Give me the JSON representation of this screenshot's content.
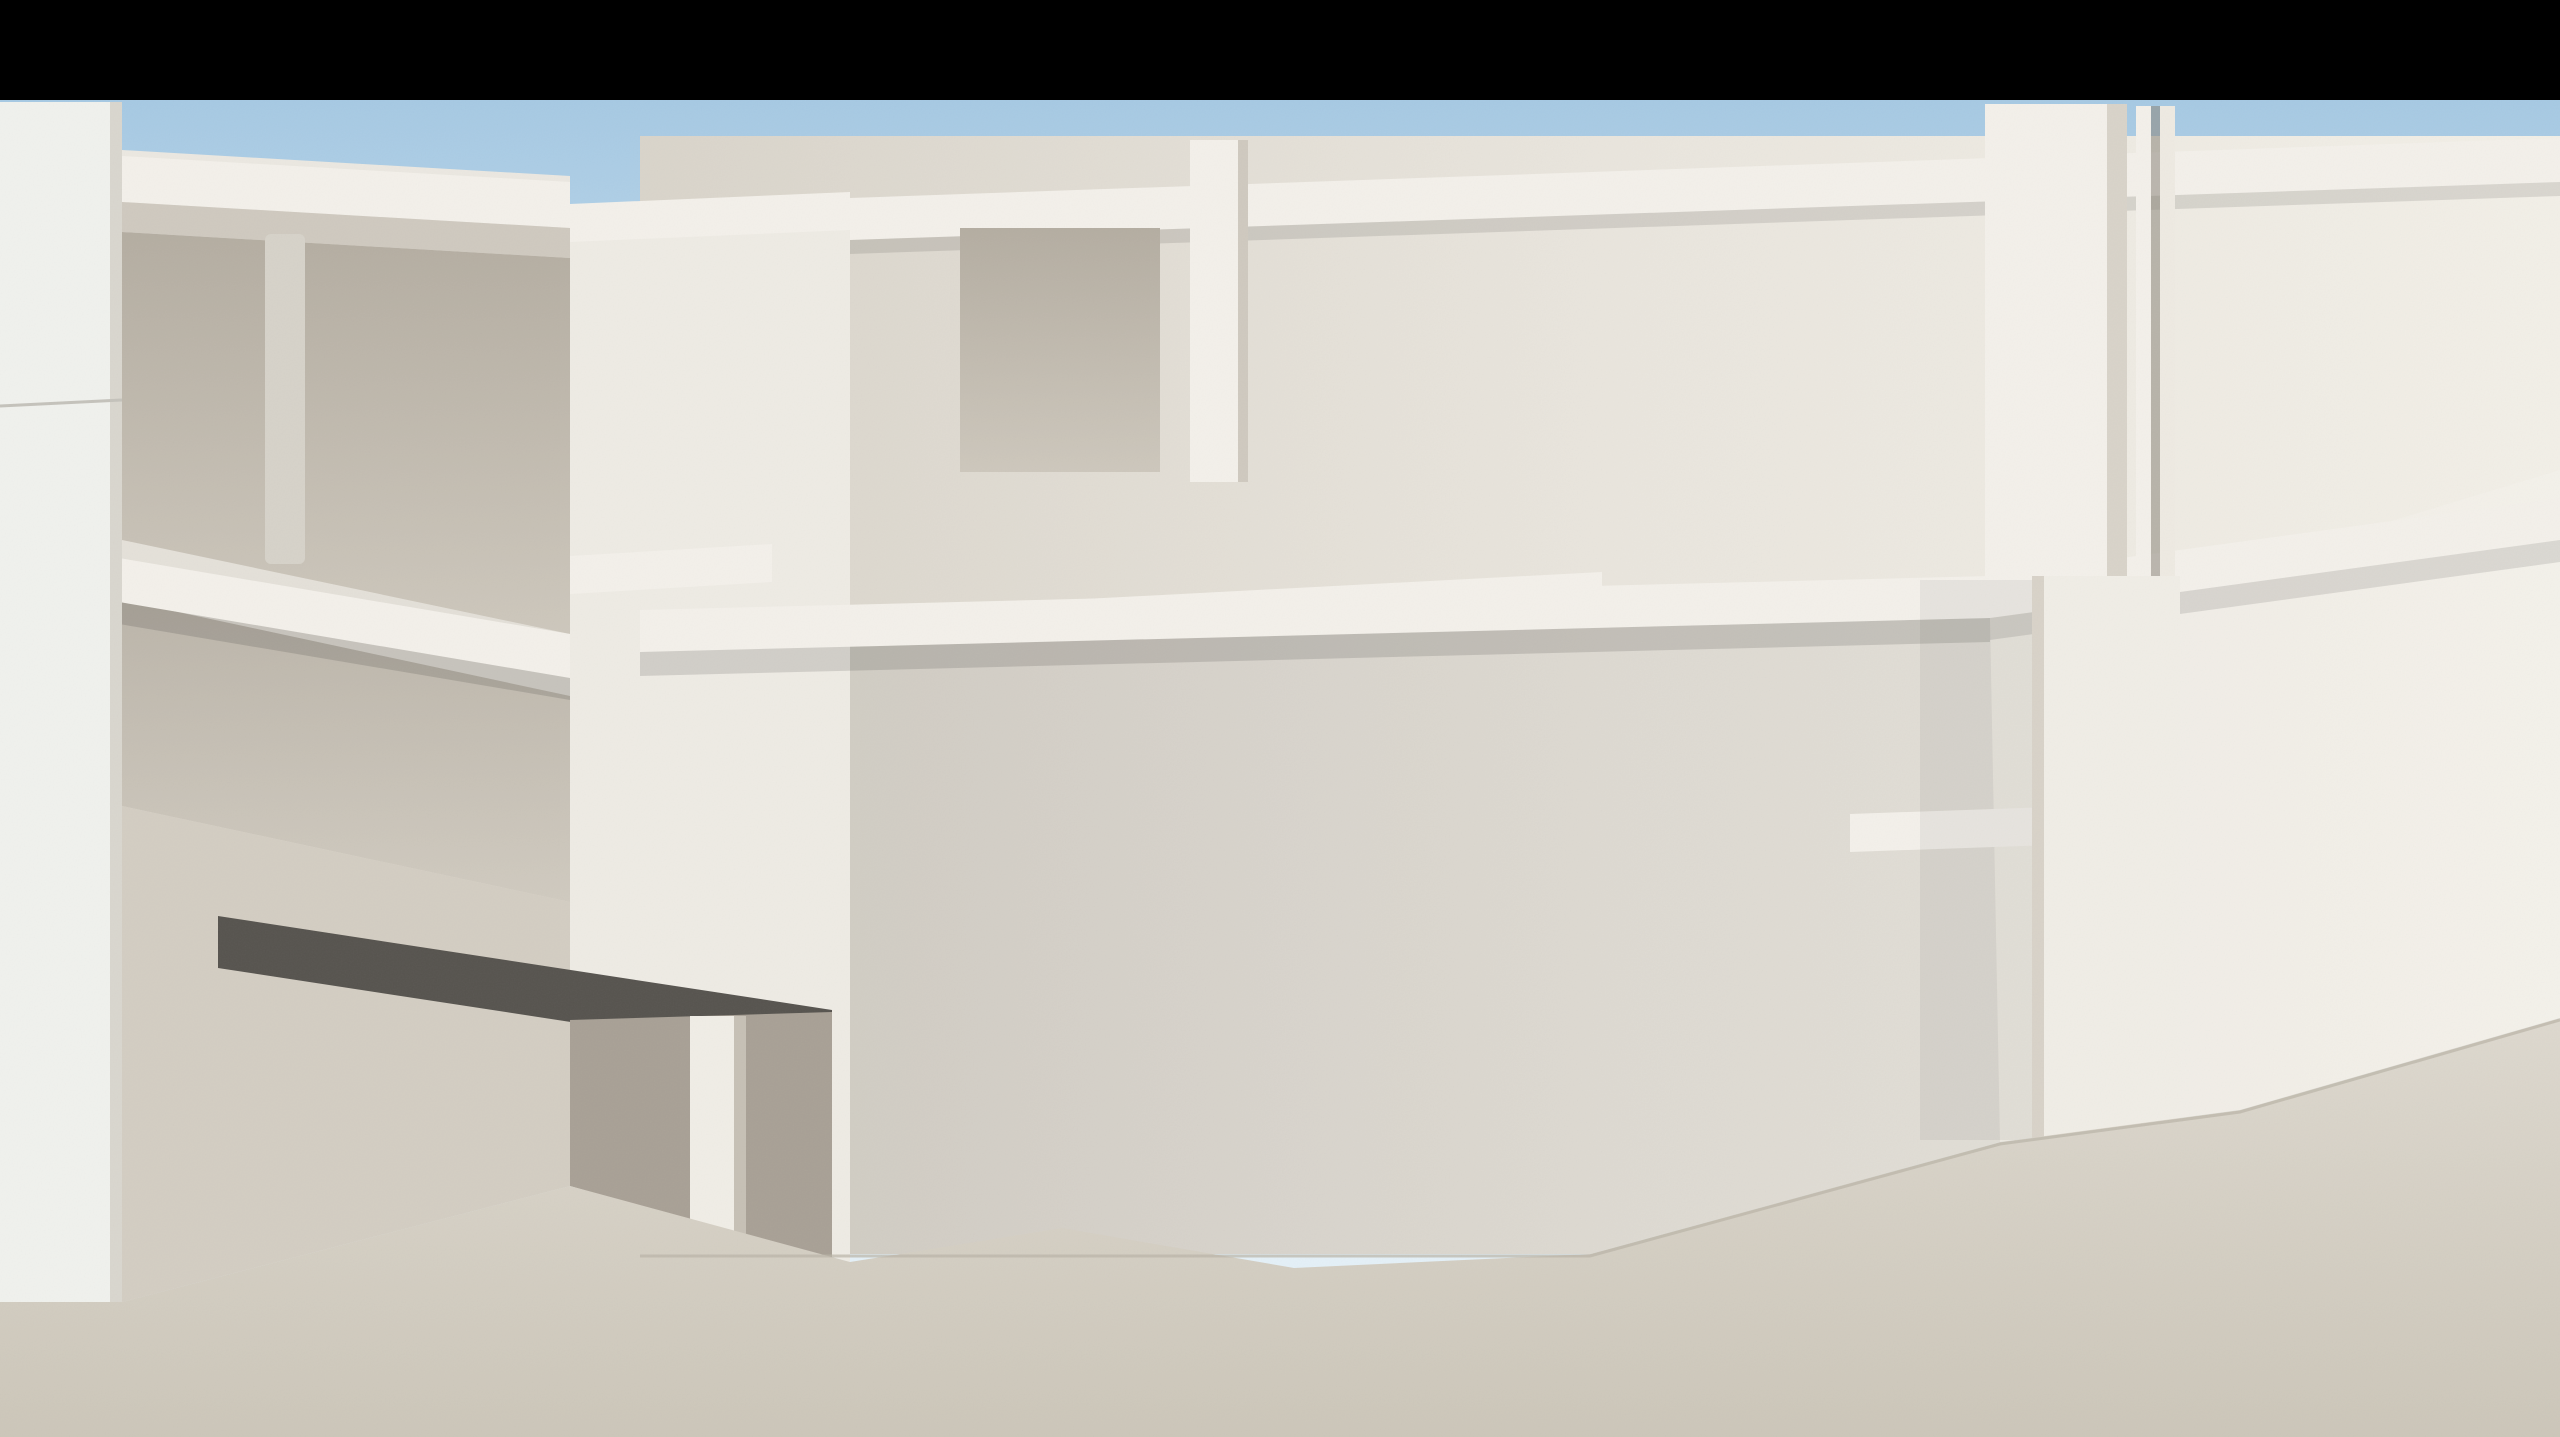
{
  "scene": {
    "kind": "3d-architectural-exterior-render",
    "subject": "modern white resort apartment complex courtyard with swimming pool, wooden deck, sun loungers, tropical plants and fountains",
    "letterbox_top_px": 100,
    "palette": {
      "letterbox": "#000000",
      "skyTop": "#a6c9e3",
      "skyMid": "#c9e0f0",
      "skyLow": "#e4f0f7",
      "cloud": "#f7fbfd",
      "wallBright": "#f3f0ea",
      "wall": "#e9e5de",
      "wallShade": "#d8d3c9",
      "wallDark": "#c6c0b5",
      "recess": "#c3bcb1",
      "interior": "#a8a095",
      "soffitDark": "#56534e",
      "frame": "#1e1d1b",
      "frameBrown": "#6e5c49",
      "curtain": "#d2c8b8",
      "curtainLit": "#ece4d6",
      "slate": "#3f413e",
      "slateDark": "#2f312e",
      "slateLight": "#4b4d4a",
      "stone": "#9c9183",
      "stoneDark": "#8a8073",
      "stoneLight": "#a89d8d",
      "deck": "#cda272",
      "deckDark": "#9f7749",
      "plankGap": "#463a2b",
      "island": "#d6ab79",
      "pave": "#d9d4c9",
      "paveDark": "#c3bdb0",
      "waterDeep": "#72c2bc",
      "water": "#a5d8d2",
      "waterPale": "#d9ece7",
      "poolLip": "#f1ece1",
      "grass": "#2a4522",
      "leafDark": "#2e5129",
      "leaf": "#4c7b42",
      "leafLight": "#79a75d",
      "flowerRed": "#bf2433",
      "flowerPink": "#c77fae",
      "woodFrame": "#c08a4a",
      "woodLeg": "#a97034",
      "cushion": "#f3efe6",
      "cushionShade": "#dcd5c6",
      "towel": "#f5f2ea",
      "potGrey": "#8f8c85",
      "potTan": "#c9b79e",
      "bollard": "#2e2d2a"
    },
    "clouds": [
      [
        1620,
        310,
        380,
        70,
        0.5
      ],
      [
        2100,
        265,
        300,
        55,
        0.42
      ],
      [
        1180,
        540,
        300,
        48,
        0.32
      ],
      [
        820,
        700,
        240,
        42,
        0.28
      ],
      [
        2420,
        530,
        260,
        45,
        0.3
      ],
      [
        380,
        250,
        300,
        60,
        0.22
      ]
    ],
    "objects": {
      "windows": [
        [
          985,
          232,
          128,
          238,
          "sky"
        ],
        [
          1195,
          228,
          128,
          236,
          "sky"
        ],
        [
          1408,
          233,
          118,
          230,
          "curt"
        ],
        [
          1662,
          240,
          126,
          233,
          "sky"
        ],
        [
          2207,
          258,
          120,
          212,
          "sky"
        ],
        [
          2368,
          268,
          170,
          196,
          "curt",
          "brown"
        ],
        [
          905,
          625,
          100,
          215,
          "curt"
        ],
        [
          1062,
          622,
          115,
          228,
          "curt"
        ],
        [
          1252,
          617,
          115,
          230,
          "curt"
        ],
        [
          1442,
          622,
          112,
          226,
          "curt"
        ],
        [
          1937,
          642,
          102,
          177,
          "sky"
        ],
        [
          2252,
          645,
          112,
          182,
          "sky"
        ],
        [
          2398,
          612,
          160,
          330,
          "curt"
        ],
        [
          900,
          942,
          92,
          235,
          "dark"
        ],
        [
          1310,
          948,
          118,
          230,
          "curt"
        ],
        [
          1612,
          912,
          132,
          262,
          "dark"
        ],
        [
          2262,
          958,
          112,
          278,
          "curt"
        ],
        [
          2428,
          988,
          130,
          262,
          "curt"
        ],
        [
          170,
          228,
          84,
          222,
          "dark"
        ],
        [
          372,
          252,
          84,
          262,
          "curt"
        ],
        [
          123,
          296,
          50,
          186,
          "dark",
          "black",
          0
        ],
        [
          170,
          602,
          84,
          232,
          "dark"
        ],
        [
          372,
          602,
          84,
          262,
          "curt"
        ],
        [
          160,
          1002,
          72,
          252,
          "dark"
        ],
        [
          300,
          1012,
          90,
          252,
          "dark"
        ],
        [
          505,
          995,
          65,
          250,
          "dark"
        ],
        [
          772,
          1032,
          168,
          198,
          "dark"
        ],
        [
          655,
          252,
          74,
          266,
          "curt"
        ],
        [
          655,
          592,
          74,
          266,
          "curt"
        ]
      ],
      "doors": [
        [
          1063,
          1006,
          158,
          192,
          "entry"
        ],
        [
          1832,
          898,
          198,
          335,
          "french"
        ]
      ],
      "claddings_travertine": [
        [
          [
            1028,
            508
          ],
          [
            1602,
            478
          ],
          [
            1602,
            574
          ],
          [
            1028,
            604
          ]
        ],
        [
          [
            790,
            462
          ],
          [
            868,
            456
          ],
          [
            868,
            592
          ],
          [
            790,
            598
          ]
        ],
        [
          [
            208,
            444
          ],
          [
            332,
            438
          ],
          [
            332,
            560
          ],
          [
            208,
            566
          ]
        ],
        [
          [
            848,
            876
          ],
          [
            1062,
            862
          ],
          [
            1062,
            894
          ],
          [
            848,
            908
          ]
        ]
      ],
      "claddings_slate": [
        [
          [
            770,
            772
          ],
          [
            802,
            768
          ],
          [
            802,
            1264
          ],
          [
            770,
            1268
          ]
        ],
        [
          [
            802,
            768
          ],
          [
            944,
            752
          ],
          [
            944,
            1252
          ],
          [
            802,
            1264
          ]
        ],
        [
          [
            1212,
            976
          ],
          [
            1294,
            968
          ],
          [
            1294,
            1106
          ],
          [
            1212,
            1112
          ]
        ],
        [
          [
            1480,
            896
          ],
          [
            1590,
            884
          ],
          [
            1590,
            1250
          ],
          [
            1480,
            1258
          ]
        ],
        [
          [
            444,
            756
          ],
          [
            510,
            750
          ],
          [
            510,
            1100
          ],
          [
            444,
            1104
          ]
        ]
      ],
      "rails": [
        [
          122,
          410,
          566,
          502,
          95
        ],
        [
          122,
          797,
          566,
          886,
          95
        ],
        [
          575,
          514,
          845,
          502,
          62
        ],
        [
          985,
          434,
          1925,
          380,
          105
        ],
        [
          2205,
          384,
          2560,
          358,
          88
        ],
        [
          1850,
          782,
          2136,
          770,
          58
        ]
      ],
      "pergola_white": {
        "x": 1893,
        "y": 150,
        "drop": 106,
        "slats": 6,
        "step": 40
      },
      "pergola_dark": {
        "x": 556,
        "y": 282,
        "w": 112,
        "slats": 4,
        "gap": 15
      },
      "halfwalls": [
        [
          838,
          1085,
          150,
          150
        ],
        [
          1222,
          1058,
          128,
          155
        ],
        [
          2270,
          1042,
          290,
          88
        ]
      ],
      "planters": [
        [
          300,
          1195,
          165,
          115,
          "red"
        ],
        [
          580,
          1330,
          175,
          80,
          "pink"
        ],
        [
          925,
          880,
          145,
          62,
          "red"
        ],
        [
          1120,
          862,
          190,
          62,
          "pink"
        ],
        [
          2352,
          1110,
          210,
          115,
          "red"
        ],
        [
          2060,
          950,
          112,
          52,
          "red"
        ]
      ],
      "plants": [
        {
          "proto": "banana",
          "x": 1372,
          "y": 470,
          "s": 0.78,
          "pot": "white"
        },
        {
          "proto": "fanpalm",
          "x": 2590,
          "y": 250,
          "s": 1.1
        },
        {
          "proto": "banana",
          "x": 1700,
          "y": 1000,
          "s": 1.5
        },
        {
          "proto": "fanpalm",
          "x": 2045,
          "y": 1052,
          "s": 0.8
        },
        {
          "proto": "banana",
          "x": 905,
          "y": 1165,
          "s": 0.95
        },
        {
          "proto": "banana",
          "x": 1290,
          "y": 1150,
          "s": 1.05,
          "flip": 1
        },
        {
          "proto": "banana",
          "x": 640,
          "y": 1330,
          "s": 1.05,
          "flip": 1
        },
        {
          "proto": "fanpalm",
          "x": 350,
          "y": 1000,
          "s": 1.55
        },
        {
          "proto": "banana",
          "x": 135,
          "y": 1230,
          "s": 1.15,
          "pot": "greyTall"
        },
        {
          "proto": "banana",
          "x": 2095,
          "y": 1300,
          "s": 1.15,
          "pot": "tan"
        },
        {
          "proto": "fanpalm",
          "x": 2500,
          "y": 1240,
          "s": 0.9,
          "light": 1
        },
        {
          "proto": "banana",
          "x": 215,
          "y": 1400,
          "s": 1.25,
          "pot": "urn"
        },
        {
          "proto": "fanpalm",
          "x": 545,
          "y": 1420,
          "s": 1.6
        },
        {
          "proto": "bush",
          "x": 1130,
          "y": 1437,
          "s": 1.3
        },
        {
          "proto": "bush",
          "x": 2235,
          "y": 1445,
          "s": 1.25
        }
      ],
      "loungers": [
        [
          75,
          1018,
          0.75,
          4,
          1
        ],
        [
          212,
          996,
          0.75,
          4,
          1
        ],
        [
          1085,
          988,
          0.72,
          -4,
          0
        ],
        [
          1248,
          966,
          0.72,
          -4,
          0
        ],
        [
          1412,
          945,
          0.72,
          -4,
          0
        ],
        [
          868,
          1168,
          1.02,
          -5,
          0
        ],
        [
          1038,
          1138,
          1.05,
          -5,
          0
        ],
        [
          1208,
          1108,
          1.07,
          -5,
          0
        ],
        [
          1378,
          1080,
          1.09,
          -5,
          0
        ],
        [
          1908,
          1292,
          1.18,
          -6,
          0
        ],
        [
          2128,
          1260,
          1.18,
          -6,
          0
        ]
      ],
      "sling_chairs": [
        [
          108,
          1368,
          1.5
        ],
        [
          425,
          1305,
          1.55
        ]
      ],
      "white_chairs": [
        [
          2352,
          1085
        ]
      ],
      "step_towels": [
        [
          2308,
          1238
        ],
        [
          2398,
          1220
        ],
        [
          2488,
          1200
        ],
        [
          2352,
          1332
        ],
        [
          2448,
          1312
        ],
        [
          2544,
          1292
        ],
        [
          2300,
          1424
        ],
        [
          2408,
          1408
        ],
        [
          2515,
          1392
        ]
      ],
      "bollard_lights": [
        [
          295,
          1258,
          36,
          168
        ],
        [
          352,
          1298,
          20,
          128
        ],
        [
          1022,
          1170,
          42,
          148
        ]
      ],
      "fountains": [
        {
          "x": 1228,
          "top": 1098,
          "base": 1302,
          "w": 64
        },
        {
          "x": 2242,
          "top": 1148,
          "base": 1430,
          "w": 76
        }
      ],
      "grass_patches": [
        [
          250,
          1352,
          240,
          48
        ],
        [
          600,
          1408,
          170,
          40
        ],
        [
          935,
          1338,
          140,
          34
        ],
        [
          1185,
          1432,
          150,
          30
        ]
      ]
    }
  }
}
